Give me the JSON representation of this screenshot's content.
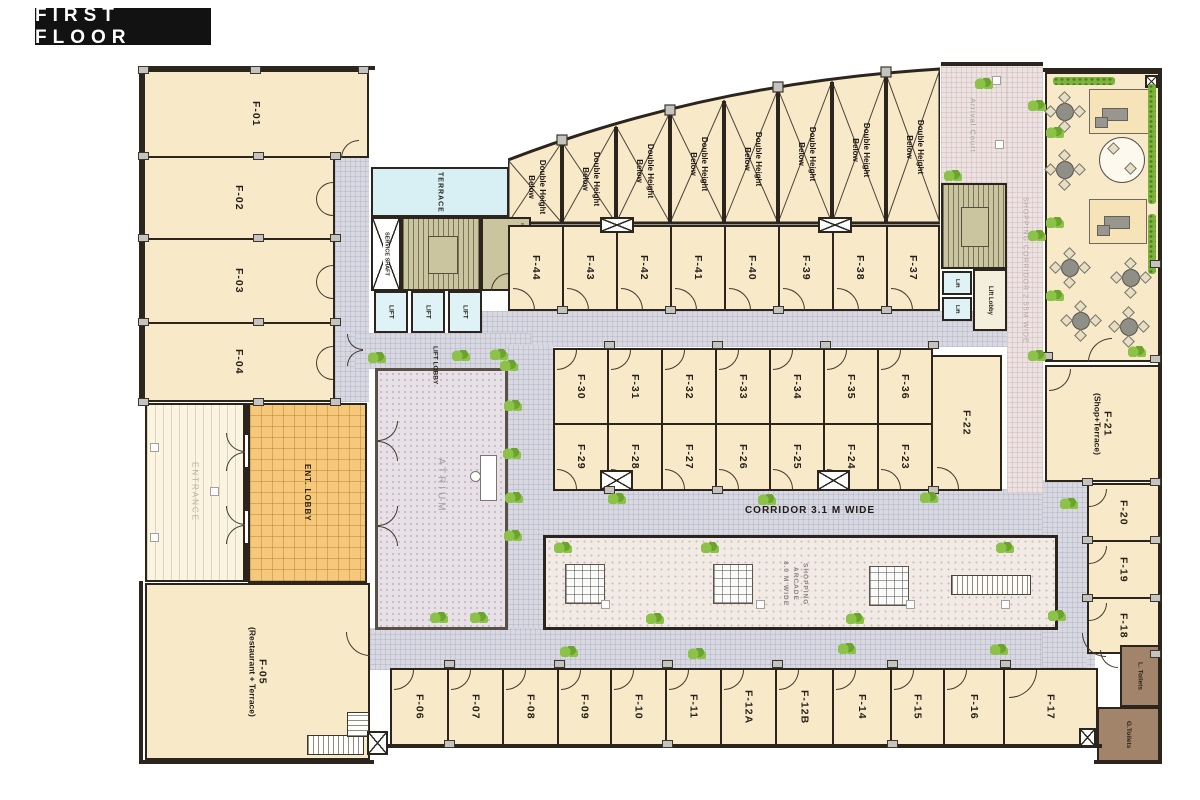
{
  "badge": {
    "title": "FIRST FLOOR"
  },
  "rooms": {
    "left": [
      "F-01",
      "F-02",
      "F-03",
      "F-04"
    ],
    "top": [
      "F-44",
      "F-43",
      "F-42",
      "F-41",
      "F-40",
      "F-39",
      "F-38",
      "F-37"
    ],
    "mid_upper": [
      "F-30",
      "F-31",
      "F-32",
      "F-33",
      "F-34",
      "F-35",
      "F-36"
    ],
    "mid_lower": [
      "F-29",
      "F-28",
      "F-27",
      "F-26",
      "F-25",
      "F-24",
      "F-23"
    ],
    "bottom": [
      "F-06",
      "F-07",
      "F-08",
      "F-09",
      "F-10",
      "F-11",
      "F-12A",
      "F-12B",
      "F-14",
      "F-15",
      "F-16",
      "F-17"
    ],
    "right": [
      "F-20",
      "F-19",
      "F-18"
    ],
    "f22": "F-22",
    "f21": {
      "name": "F-21",
      "sub": "(Shop+Terrace)"
    },
    "f05": {
      "name": "F-05",
      "sub": "(Restaurant + Terrace)"
    }
  },
  "labels": {
    "terrace": "TERRACE",
    "service_shaft": "SERVICE SHAFT",
    "lift": "LIFT",
    "lift_small": "Lift",
    "lift_lobby": "LIFT LOBBY",
    "lift_lobby_right": "Lift Lobby",
    "atrium": "ATRIUM",
    "entrance": "ENTRANCE",
    "ent_lobby": "ENT. LOBBY",
    "arrival_court": "Arrival Court",
    "shopping_corridor": "SHOPPING CORRIDOR 2.55M WIDE",
    "corridor": "CORRIDOR 3.1 M WIDE",
    "arcade_l1": "SHOPPING",
    "arcade_l2": "ARCADE",
    "arcade_l3": "8.0 M WIDE",
    "double_height_l1": "Double Height",
    "double_height_l2": "Below",
    "l_toilets": "L. Toilets",
    "g_toilets": "G.Toilets",
    "el_room": "El. Room"
  },
  "colors": {
    "room_fill": "#f8e9c9",
    "wall": "#2b251e",
    "corridor": "#d8d8e1",
    "pink_corridor": "#ece2e2",
    "terrace": "#d8f0f4",
    "lift": "#dff3f7",
    "stair": "#cac49f",
    "ent_lobby": "#f5c87b",
    "atrium": "#e7e1e7",
    "toilet": "#a1846a",
    "plant": "#7cb33b",
    "badge_bg": "#121212"
  }
}
